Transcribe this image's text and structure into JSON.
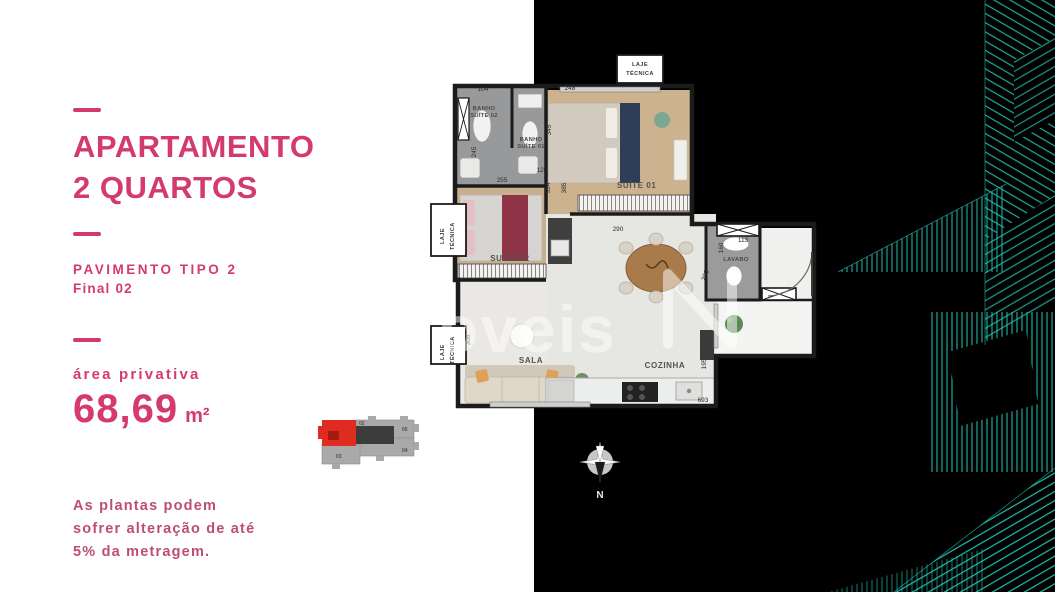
{
  "colors": {
    "accent_pink": "#d43a6f",
    "muted_pink": "#bd4e70",
    "teal_lines": "#1fbfae",
    "key_plan_highlight": "#e02b20",
    "background_left": "#ffffff",
    "background_right": "#000000"
  },
  "left_panel": {
    "title_line1": "APARTAMENTO",
    "title_line2": "2 QUARTOS",
    "subtitle_line1": "PAVIMENTO TIPO 2",
    "subtitle_line2": "Final 02",
    "area_label": "área privativa",
    "area_value": "68,69",
    "area_unit": "m²",
    "disclaimer": "As plantas podem sofrer alteração de até 5% da metragem."
  },
  "floor_plan": {
    "rooms": {
      "banho": "BANHO",
      "suite01": "SUÍTE 01",
      "suite02": "SUÍTE 02",
      "sala": "SALA",
      "cozinha": "COZINHA",
      "lavabo": "LAVABO",
      "laje": "LAJE",
      "tecnica": "TÉCNICA"
    },
    "dimensions": {
      "d104": "104",
      "d248": "248",
      "d245": "245",
      "d345": "345",
      "d120": "120",
      "d255": "255",
      "d324": "324",
      "d385": "385",
      "d290": "290",
      "d160": "160",
      "d113": "113",
      "d203": "203",
      "d305": "305",
      "d195": "195",
      "d693": "693"
    },
    "compass_label": "N",
    "watermark_text": "oveis"
  },
  "key_plan": {
    "unit_02": "02",
    "unit_03": "03",
    "unit_04": "04",
    "unit_05": "05"
  }
}
